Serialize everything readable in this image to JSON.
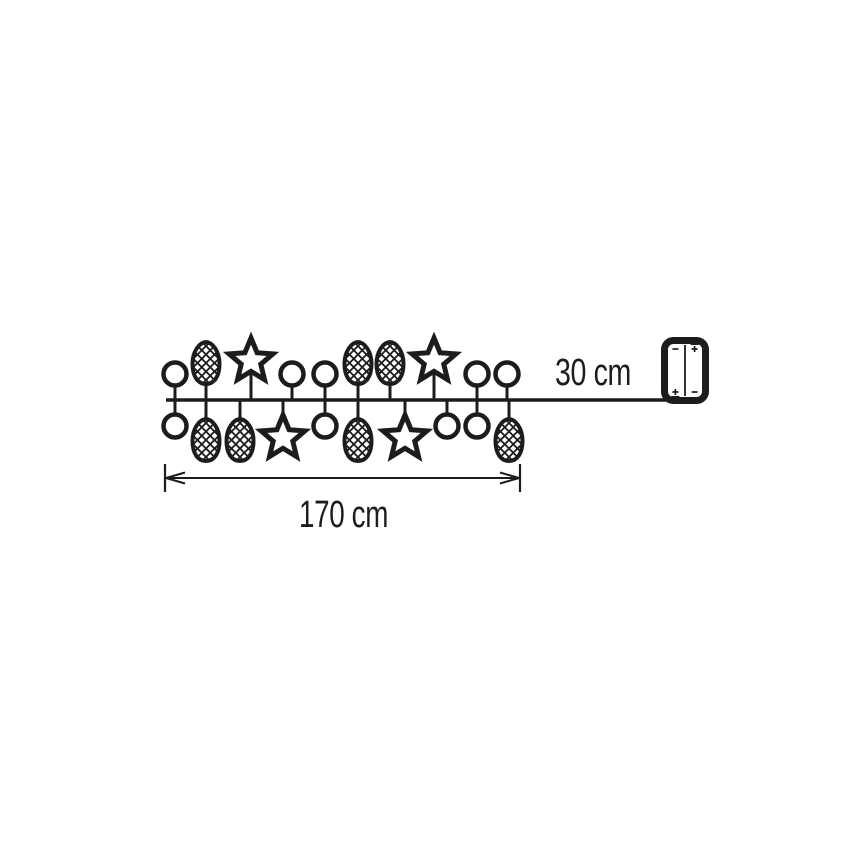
{
  "page": {
    "background": "#ffffff"
  },
  "diagram": {
    "kind": "product-dimension-diagram",
    "subject": "light chain with ball, pinecone and star ornaments, lead wire and two-cell battery box",
    "ink_color": "#1c1c1c",
    "labels": {
      "lead_length": "30 cm",
      "chain_length": "170 cm"
    },
    "chain": {
      "wire_y": 400,
      "wire_x_start": 166,
      "wire_x_end": 668,
      "ornaments": [
        {
          "type": "ball",
          "side": "top",
          "x": 175
        },
        {
          "type": "ball",
          "side": "bottom",
          "x": 175
        },
        {
          "type": "pinecone",
          "side": "top",
          "x": 206
        },
        {
          "type": "pinecone",
          "side": "bottom",
          "x": 206
        },
        {
          "type": "pinecone",
          "side": "bottom",
          "x": 240
        },
        {
          "type": "star",
          "side": "top",
          "x": 251
        },
        {
          "type": "star",
          "side": "bottom",
          "x": 283
        },
        {
          "type": "ball",
          "side": "top",
          "x": 292
        },
        {
          "type": "ball",
          "side": "top",
          "x": 325
        },
        {
          "type": "ball",
          "side": "bottom",
          "x": 325
        },
        {
          "type": "pinecone",
          "side": "top",
          "x": 358
        },
        {
          "type": "pinecone",
          "side": "bottom",
          "x": 358
        },
        {
          "type": "pinecone",
          "side": "top",
          "x": 390
        },
        {
          "type": "star",
          "side": "bottom",
          "x": 405
        },
        {
          "type": "star",
          "side": "top",
          "x": 434
        },
        {
          "type": "ball",
          "side": "bottom",
          "x": 447
        },
        {
          "type": "ball",
          "side": "top",
          "x": 477
        },
        {
          "type": "ball",
          "side": "bottom",
          "x": 477
        },
        {
          "type": "ball",
          "side": "top",
          "x": 507
        },
        {
          "type": "pinecone",
          "side": "bottom",
          "x": 509
        }
      ]
    },
    "dimension": {
      "x_start": 165,
      "x_end": 520,
      "y": 478,
      "tick_half_height": 14
    },
    "battery_box": {
      "x": 661,
      "y": 337,
      "width": 48,
      "height": 67,
      "cells": [
        {
          "top_symbol": "-",
          "bottom_symbol": "+"
        },
        {
          "top_symbol": "+",
          "bottom_symbol": "-"
        }
      ]
    }
  }
}
